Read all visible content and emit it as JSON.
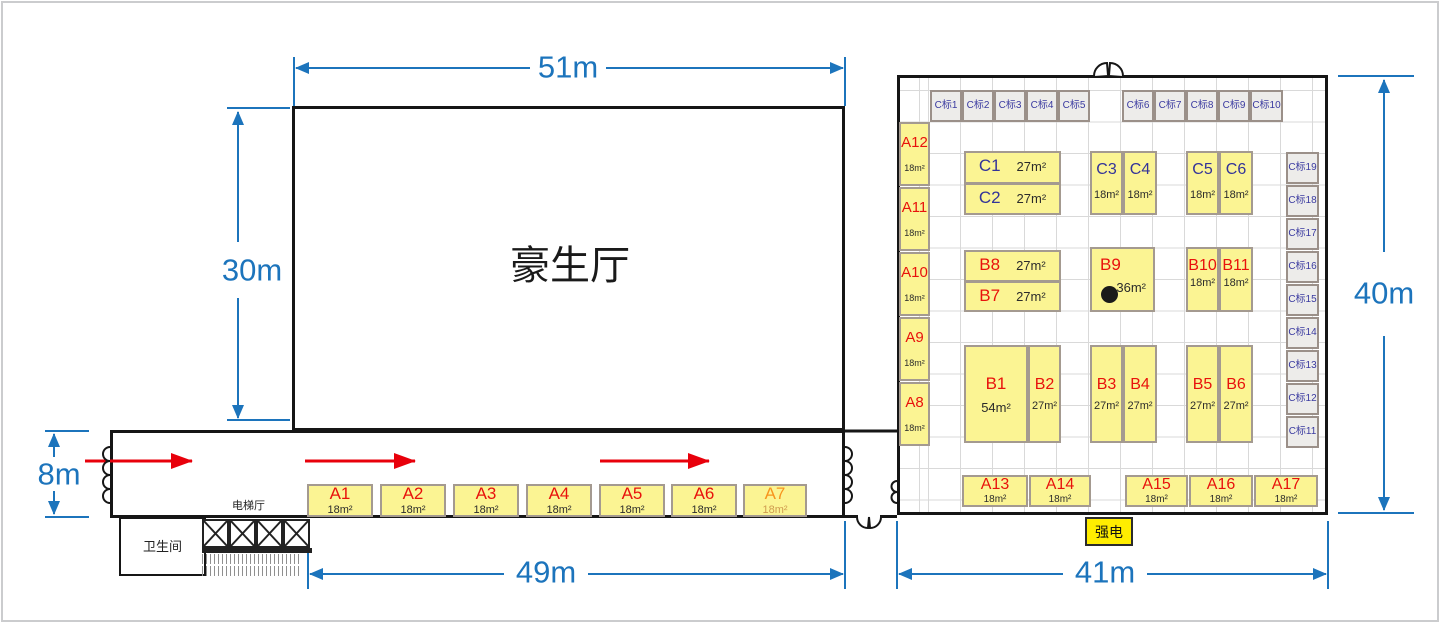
{
  "hall": {
    "label": "豪生厅"
  },
  "dimensions": {
    "top": "51m",
    "hall_left": "30m",
    "entry_left": "8m",
    "bottom_left": "49m",
    "bottom_right": "41m",
    "right": "40m"
  },
  "rooms": {
    "restroom": "卫生间",
    "elevator_hall": "电梯厅",
    "power": "强电"
  },
  "corridor_booths": [
    {
      "id": "A1",
      "area": "18m²"
    },
    {
      "id": "A2",
      "area": "18m²"
    },
    {
      "id": "A3",
      "area": "18m²"
    },
    {
      "id": "A4",
      "area": "18m²"
    },
    {
      "id": "A5",
      "area": "18m²"
    },
    {
      "id": "A6",
      "area": "18m²"
    },
    {
      "id": "A7",
      "area": "18m²"
    }
  ],
  "left_column_booths": [
    {
      "id": "A12",
      "area": "18m²"
    },
    {
      "id": "A11",
      "area": "18m²"
    },
    {
      "id": "A10",
      "area": "18m²"
    },
    {
      "id": "A9",
      "area": "18m²"
    },
    {
      "id": "A8",
      "area": "18m²"
    }
  ],
  "bottom_row_booths": [
    {
      "id": "A13",
      "area": "18m²"
    },
    {
      "id": "A14",
      "area": "18m²"
    },
    {
      "id": "A15",
      "area": "18m²"
    },
    {
      "id": "A16",
      "area": "18m²"
    },
    {
      "id": "A17",
      "area": "18m²"
    }
  ],
  "c_booths": [
    {
      "id": "C1",
      "area": "27m²"
    },
    {
      "id": "C2",
      "area": "27m²"
    },
    {
      "id": "C3",
      "area": "18m²"
    },
    {
      "id": "C4",
      "area": "18m²"
    },
    {
      "id": "C5",
      "area": "18m²"
    },
    {
      "id": "C6",
      "area": "18m²"
    }
  ],
  "b_booths": [
    {
      "id": "B8",
      "area": "27m²"
    },
    {
      "id": "B7",
      "area": "27m²"
    },
    {
      "id": "B9",
      "area": "36m²"
    },
    {
      "id": "B10",
      "area": "18m²"
    },
    {
      "id": "B11",
      "area": "18m²"
    },
    {
      "id": "B1",
      "area": "54m²"
    },
    {
      "id": "B2",
      "area": "27m²"
    },
    {
      "id": "B3",
      "area": "27m²"
    },
    {
      "id": "B4",
      "area": "27m²"
    },
    {
      "id": "B5",
      "area": "27m²"
    },
    {
      "id": "B6",
      "area": "27m²"
    }
  ],
  "standard_booths_top": [
    "C标1",
    "C标2",
    "C标3",
    "C标4",
    "C标5",
    "C标6",
    "C标7",
    "C标8",
    "C标9",
    "C标10"
  ],
  "standard_booths_right": [
    "C标19",
    "C标18",
    "C标17",
    "C标16",
    "C标15",
    "C标14",
    "C标13",
    "C标12",
    "C标11"
  ],
  "colors": {
    "booth_yellow": "#FBF493",
    "booth_red": "#E8120C",
    "booth_navy": "#333399",
    "booth_orange": "#F7941D",
    "dimension_blue": "#1C74BC",
    "arrow_red": "#E8000B",
    "power_yellow": "#FFED00"
  }
}
